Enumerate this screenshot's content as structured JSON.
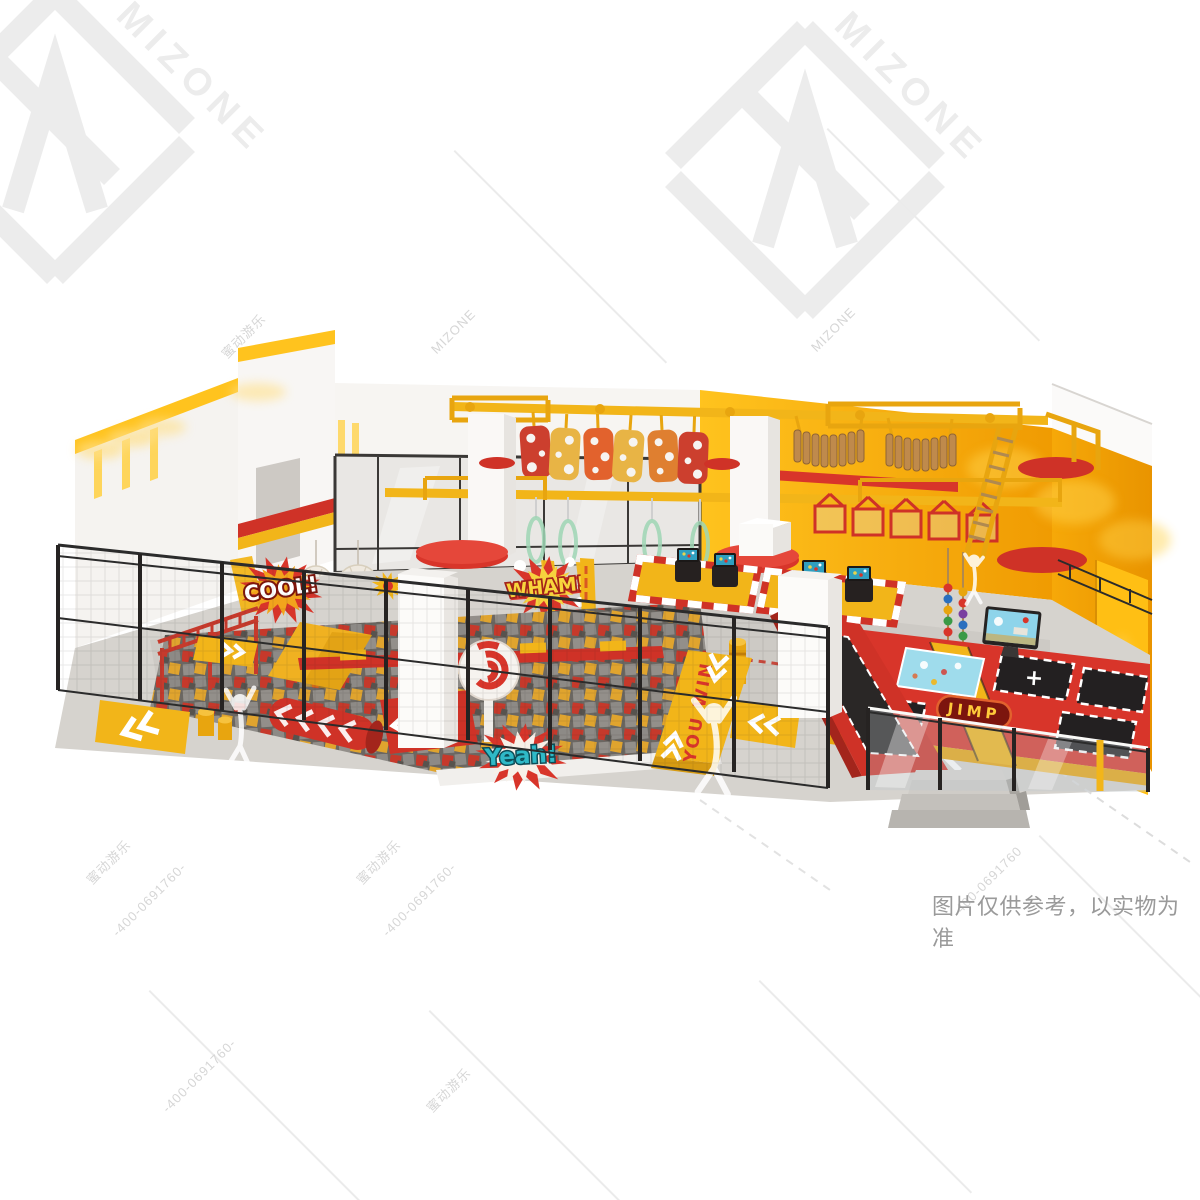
{
  "image": {
    "type": "3d-render",
    "subject": "indoor trampoline park and ninja-course playground design",
    "style": "isometric product render on white background with brand watermarks"
  },
  "watermark": {
    "brand_en": "MIZONE",
    "brand_cn": "蜜动游乐",
    "phone": "400-0691760",
    "phone_decorated": "-400-0691760-",
    "logo_color": "#ececec",
    "text_color": "#d6d6d6"
  },
  "disclaimer": {
    "text": "图片仅供参考，以实物为准",
    "color": "#9a9a9a"
  },
  "scene": {
    "decals": {
      "cool": "COOL!",
      "wham": "WHAM!",
      "yeah": "Yeah!",
      "you_win": "YOU WIN",
      "jump_sign": "JIMP",
      "plus_marker": "+"
    },
    "palette": {
      "yellow": "#f2b519",
      "deep_yellow": "#eb9b07",
      "wall_yellow": "#ffc01e",
      "red": "#d8352a",
      "dark_red": "#a3251c",
      "maroon": "#7c150e",
      "black": "#262322",
      "floor_gray": "#d6d3ce",
      "wall_white": "#f6f4f1",
      "glass": "#e9e7e4",
      "wood": "#bf8a4c",
      "teal": "#2fb9c7",
      "screen_blue": "#8ed4ea",
      "cube_gray": "#8d8a86"
    }
  }
}
